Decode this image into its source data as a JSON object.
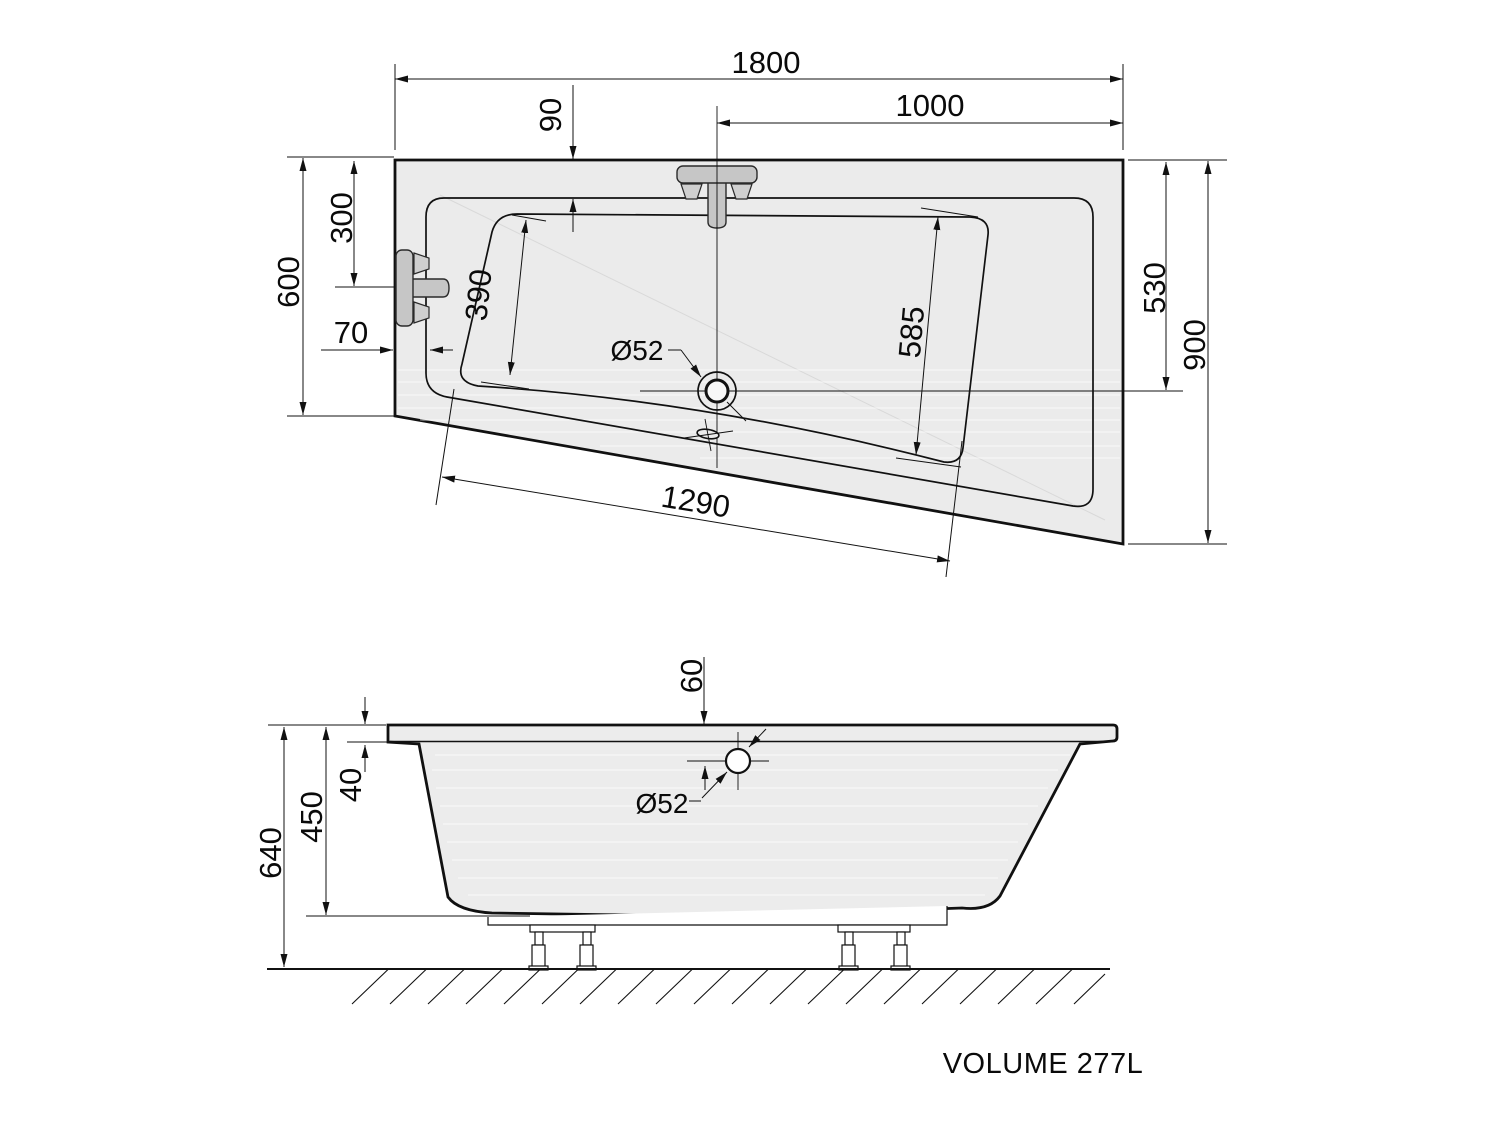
{
  "plan": {
    "overall_width": "1800",
    "drain_offset_right": "1000",
    "rim_width_top": "90",
    "tap_offset_left": "300",
    "left_side_height": "600",
    "rim_width_left": "70",
    "basin_left_edge": "390",
    "basin_right_edge": "585",
    "drain_offset_top_right": "530",
    "right_side_height": "900",
    "basin_bottom_edge": "1290",
    "drain_diameter": "Ø52"
  },
  "elevation": {
    "overflow_offset": "60",
    "rim_thickness": "40",
    "inner_depth": "450",
    "total_height": "640",
    "overflow_diameter": "Ø52"
  },
  "footer": {
    "volume_label": "VOLUME 277L"
  },
  "colors": {
    "line": "#111111",
    "tub_fill": "#ebebeb",
    "fitting_fill": "#c6c6c6",
    "background": "#ffffff"
  }
}
